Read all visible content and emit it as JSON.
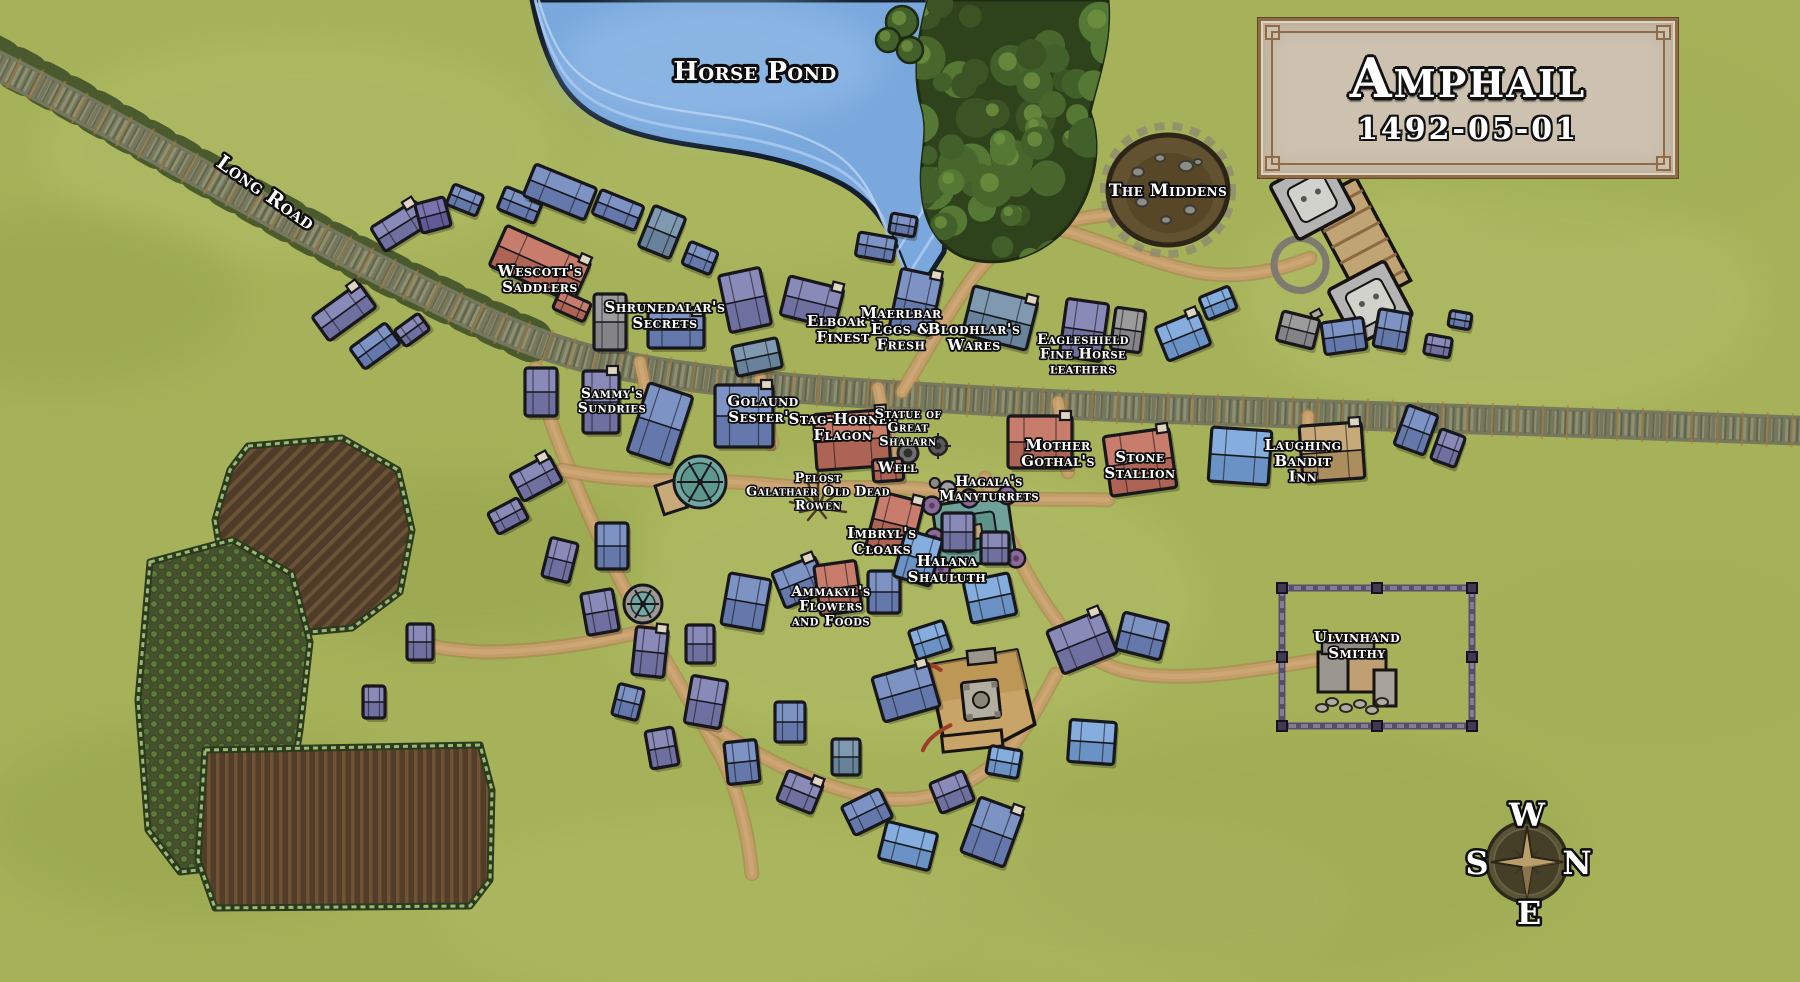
{
  "map": {
    "name": "Amphail village map",
    "title_plaque": {
      "title": "Amphail",
      "date": "1492-05-01"
    },
    "compass": {
      "top": "W",
      "right": "N",
      "bottom": "E",
      "left": "S"
    },
    "palette": {
      "grass": "#a6b259",
      "grass_light": "#b5c16c",
      "grass_dark": "#93a24b",
      "water": "#7aa8dc",
      "water_light": "#93bce8",
      "water_edge": "#141e2c",
      "stone_road": "#75785c",
      "stone_road_light": "#8e9170",
      "stone_road_dark": "#5c5f49",
      "dirt_road": "#c49d6b",
      "dirt_road_edge": "#a97f4e",
      "forest_dark": "#2e421c",
      "forest_mid": "#49672c",
      "forest_light": "#6f9140",
      "outline": "#17171c",
      "label_fill": "#ffffff",
      "label_outline": "#0e0e0e",
      "plaque_bg": "#cdc2b0",
      "plaque_border": "#8f6c46",
      "building_purple": "#8a8ab8",
      "building_slate": "#7d93c4",
      "building_blue": "#85aede",
      "building_steel": "#7f9ab0",
      "building_gray": "#9c9c9c",
      "building_red": "#c87d6c",
      "building_tan": "#c8aa7a",
      "building_violet": "#7a74ae"
    },
    "geography": {
      "labels": [
        {
          "name": "horse-pond",
          "lines": [
            "Horse Pond"
          ],
          "x": 755,
          "y": 80,
          "size": 26
        },
        {
          "name": "long-road",
          "lines": [
            "Long Road"
          ],
          "x": 262,
          "y": 198,
          "size": 20,
          "rot": 35,
          "spacing": 3
        },
        {
          "name": "the-middens",
          "lines": [
            "The Middens"
          ],
          "x": 1168,
          "y": 196,
          "size": 17
        },
        {
          "name": "wescotts-saddlers",
          "lines": [
            "Wescott's",
            "Saddlers"
          ],
          "x": 540,
          "y": 276,
          "size": 15
        },
        {
          "name": "shrunedalars-secrets",
          "lines": [
            "Shrunedalar's",
            "Secrets"
          ],
          "x": 665,
          "y": 312,
          "size": 15
        },
        {
          "name": "elboars-finest",
          "lines": [
            "Elboar's",
            "Finest"
          ],
          "x": 843,
          "y": 326,
          "size": 15
        },
        {
          "name": "maerlbar-eggs",
          "lines": [
            "Maerlbar",
            "Eggs &",
            "Fresh"
          ],
          "x": 901,
          "y": 318,
          "size": 15
        },
        {
          "name": "blodhlars-wares",
          "lines": [
            "Blodhlar's",
            "Wares"
          ],
          "x": 974,
          "y": 334,
          "size": 15
        },
        {
          "name": "eagleshield-leathers",
          "lines": [
            "Eagleshield",
            "Fine Horse",
            "leathers"
          ],
          "x": 1083,
          "y": 344,
          "size": 14
        },
        {
          "name": "sammys-sundries",
          "lines": [
            "Sammy's",
            "Sundries"
          ],
          "x": 612,
          "y": 398,
          "size": 14
        },
        {
          "name": "golaund-sesters",
          "lines": [
            "Golaund",
            "Sester's"
          ],
          "x": 763,
          "y": 406,
          "size": 15
        },
        {
          "name": "stag-horned-flagon",
          "lines": [
            "Stag-Horned",
            "Flagon"
          ],
          "x": 843,
          "y": 424,
          "size": 15
        },
        {
          "name": "statue-of-great-shalarn",
          "lines": [
            "Statue of",
            "Great",
            "Shalarn"
          ],
          "x": 908,
          "y": 418,
          "size": 13
        },
        {
          "name": "well",
          "lines": [
            "Well"
          ],
          "x": 898,
          "y": 472,
          "size": 14
        },
        {
          "name": "mother-gothals",
          "lines": [
            "Mother",
            "Gothal's"
          ],
          "x": 1058,
          "y": 450,
          "size": 15
        },
        {
          "name": "stone-stallion",
          "lines": [
            "Stone",
            "Stallion"
          ],
          "x": 1140,
          "y": 462,
          "size": 15
        },
        {
          "name": "laughing-bandit-inn",
          "lines": [
            "Laughing",
            "Bandit",
            "Inn"
          ],
          "x": 1303,
          "y": 450,
          "size": 15
        },
        {
          "name": "pelost-galathaer-old-dead-rowen",
          "lines": [
            "Pelost",
            "Galathaer Old Dead",
            "Rowen"
          ],
          "x": 818,
          "y": 482,
          "size": 13
        },
        {
          "name": "hagalas-manyturrets",
          "lines": [
            "Hagala's",
            "Manyturrets"
          ],
          "x": 989,
          "y": 486,
          "size": 14
        },
        {
          "name": "imbryls-cloaks",
          "lines": [
            "Imbryl's",
            "Cloaks"
          ],
          "x": 882,
          "y": 538,
          "size": 15
        },
        {
          "name": "halana-shauluth",
          "lines": [
            "Halana",
            "Shauluth"
          ],
          "x": 947,
          "y": 566,
          "size": 15
        },
        {
          "name": "ammakyls-flowers",
          "lines": [
            "Ammakyl's",
            "Flowers",
            "and Foods"
          ],
          "x": 831,
          "y": 596,
          "size": 14
        },
        {
          "name": "ulvinhand-smithy",
          "lines": [
            "Ulvinhand",
            "Smithy"
          ],
          "x": 1357,
          "y": 642,
          "size": 15
        }
      ]
    },
    "buildings_format": "[cx, cy, width, height, rotation_deg, color_key, chimney_flag]",
    "building_colors": {
      "p": "purple",
      "s": "slate",
      "b": "blue",
      "t": "steel",
      "g": "gray",
      "r": "red",
      "n": "tan",
      "v": "violet"
    },
    "buildings": [
      [
        344,
        312,
        58,
        30,
        -36,
        "p",
        1
      ],
      [
        375,
        346,
        44,
        26,
        -36,
        "s"
      ],
      [
        412,
        330,
        30,
        20,
        -36,
        "p"
      ],
      [
        400,
        226,
        52,
        28,
        -32,
        "p",
        1
      ],
      [
        433,
        215,
        30,
        30,
        -15,
        "v"
      ],
      [
        465,
        200,
        32,
        22,
        22,
        "s"
      ],
      [
        520,
        205,
        40,
        24,
        22,
        "s",
        1
      ],
      [
        560,
        192,
        66,
        34,
        22,
        "s"
      ],
      [
        618,
        210,
        46,
        26,
        22,
        "s"
      ],
      [
        662,
        232,
        34,
        44,
        22,
        "t"
      ],
      [
        700,
        258,
        30,
        24,
        22,
        "s"
      ],
      [
        540,
        264,
        92,
        44,
        24,
        "r",
        1
      ],
      [
        572,
        306,
        34,
        20,
        24,
        "r"
      ],
      [
        610,
        322,
        32,
        56,
        0,
        "g"
      ],
      [
        676,
        330,
        56,
        36,
        0,
        "s",
        1
      ],
      [
        745,
        300,
        42,
        58,
        -12,
        "p"
      ],
      [
        757,
        357,
        46,
        30,
        -12,
        "t"
      ],
      [
        812,
        302,
        56,
        40,
        14,
        "p",
        1
      ],
      [
        876,
        247,
        38,
        24,
        10,
        "s"
      ],
      [
        903,
        225,
        26,
        20,
        10,
        "s"
      ],
      [
        916,
        302,
        42,
        60,
        12,
        "s",
        1
      ],
      [
        1000,
        318,
        66,
        50,
        14,
        "t",
        1
      ],
      [
        1084,
        330,
        42,
        58,
        8,
        "p"
      ],
      [
        1128,
        330,
        30,
        42,
        8,
        "g"
      ],
      [
        1183,
        336,
        46,
        36,
        -22,
        "b",
        1
      ],
      [
        1218,
        303,
        32,
        24,
        -22,
        "b"
      ],
      [
        1298,
        330,
        38,
        30,
        14,
        "g"
      ],
      [
        1344,
        336,
        42,
        32,
        -8,
        "s"
      ],
      [
        1392,
        330,
        32,
        38,
        10,
        "s"
      ],
      [
        1438,
        346,
        26,
        20,
        10,
        "p"
      ],
      [
        1460,
        320,
        22,
        16,
        10,
        "s"
      ],
      [
        541,
        392,
        32,
        48,
        0,
        "p"
      ],
      [
        601,
        402,
        36,
        62,
        0,
        "p",
        1
      ],
      [
        660,
        424,
        46,
        72,
        18,
        "s"
      ],
      [
        744,
        416,
        58,
        62,
        0,
        "s",
        1
      ],
      [
        852,
        440,
        74,
        56,
        -4,
        "r",
        1
      ],
      [
        888,
        470,
        30,
        22,
        -4,
        "r"
      ],
      [
        1040,
        442,
        64,
        52,
        0,
        "r",
        1
      ],
      [
        1140,
        462,
        66,
        60,
        -8,
        "r",
        1
      ],
      [
        1240,
        456,
        60,
        54,
        4,
        "b"
      ],
      [
        1332,
        452,
        62,
        56,
        -4,
        "n",
        1
      ],
      [
        1416,
        430,
        32,
        42,
        20,
        "s"
      ],
      [
        1448,
        448,
        26,
        32,
        20,
        "p"
      ],
      [
        536,
        478,
        44,
        30,
        -28,
        "p",
        1
      ],
      [
        508,
        516,
        34,
        24,
        -28,
        "p"
      ],
      [
        560,
        560,
        28,
        40,
        14,
        "p"
      ],
      [
        612,
        546,
        32,
        46,
        0,
        "s"
      ],
      [
        600,
        612,
        32,
        42,
        -10,
        "p"
      ],
      [
        650,
        652,
        32,
        48,
        6,
        "p",
        1
      ],
      [
        700,
        644,
        28,
        38,
        0,
        "p"
      ],
      [
        746,
        602,
        42,
        52,
        10,
        "s"
      ],
      [
        800,
        582,
        46,
        38,
        -22,
        "s",
        1
      ],
      [
        838,
        588,
        42,
        50,
        -8,
        "r"
      ],
      [
        895,
        524,
        46,
        56,
        14,
        "r",
        1
      ],
      [
        884,
        592,
        32,
        42,
        0,
        "s"
      ],
      [
        918,
        558,
        38,
        48,
        16,
        "b"
      ],
      [
        958,
        532,
        32,
        38,
        0,
        "p"
      ],
      [
        995,
        548,
        28,
        32,
        0,
        "p"
      ],
      [
        990,
        598,
        46,
        42,
        -12,
        "b"
      ],
      [
        930,
        640,
        36,
        30,
        -18,
        "b"
      ],
      [
        706,
        702,
        36,
        48,
        10,
        "p"
      ],
      [
        742,
        762,
        32,
        42,
        -6,
        "s"
      ],
      [
        790,
        722,
        30,
        40,
        0,
        "s"
      ],
      [
        800,
        792,
        38,
        32,
        22,
        "p",
        1
      ],
      [
        846,
        757,
        28,
        36,
        0,
        "t"
      ],
      [
        906,
        692,
        58,
        46,
        -16,
        "s",
        1
      ],
      [
        867,
        812,
        42,
        32,
        -26,
        "s"
      ],
      [
        908,
        846,
        52,
        38,
        14,
        "b"
      ],
      [
        952,
        792,
        36,
        32,
        -22,
        "p"
      ],
      [
        992,
        832,
        46,
        58,
        20,
        "s",
        1
      ],
      [
        1004,
        762,
        32,
        28,
        10,
        "b"
      ],
      [
        1082,
        642,
        58,
        46,
        -22,
        "p",
        1
      ],
      [
        1142,
        636,
        46,
        38,
        14,
        "s"
      ],
      [
        1092,
        742,
        46,
        42,
        4,
        "b"
      ],
      [
        662,
        748,
        28,
        38,
        -10,
        "p"
      ],
      [
        628,
        702,
        26,
        32,
        14,
        "s"
      ],
      [
        420,
        642,
        26,
        36,
        0,
        "p"
      ],
      [
        374,
        702,
        22,
        32,
        0,
        "p"
      ]
    ],
    "structures": {
      "middens": {
        "x": 1168,
        "y": 190
      },
      "manor_ruin": {
        "x": 1348,
        "y": 248,
        "rot": -28
      },
      "hagala_turrets": {
        "x": 974,
        "y": 532
      },
      "tan_complex": {
        "x": 980,
        "y": 700,
        "rot": -6
      },
      "smithy": {
        "x": 1352,
        "y": 678
      },
      "enclosure": {
        "x": 1282,
        "y": 588,
        "w": 190,
        "h": 138
      },
      "mill_a": {
        "x": 700,
        "y": 482,
        "r": 26
      },
      "mill_b": {
        "x": 643,
        "y": 604,
        "r": 19
      },
      "statue": {
        "x": 938,
        "y": 446
      },
      "well": {
        "x": 908,
        "y": 453
      },
      "dead_tree": {
        "x": 818,
        "y": 508
      },
      "compass": {
        "x": 1527,
        "y": 862
      }
    }
  }
}
